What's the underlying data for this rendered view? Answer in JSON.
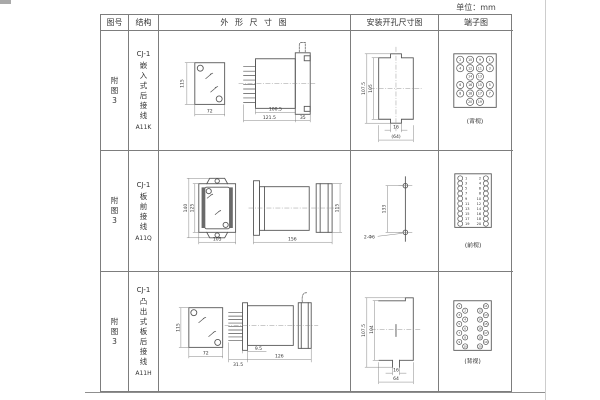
{
  "page": {
    "unit_label": "单位：mm"
  },
  "table": {
    "headers": {
      "fig": "图号",
      "structure": "结构",
      "outline": "外 形 尺 寸 图",
      "mounting": "安装开孔尺寸图",
      "terminal": "端子图"
    }
  },
  "rows": [
    {
      "fig": "附\n图\n3",
      "model": "CJ-1",
      "desc": "嵌\n入\n式\n后\n接\n线",
      "code": "A11K",
      "view_label": "(背视)",
      "dims": {
        "front_h": "115",
        "front_w": "72",
        "body": "100.5",
        "total": "121.5",
        "flange": "35"
      },
      "mount_dims": {
        "outer": "107.5",
        "inner": "105",
        "slot": "16",
        "width": "(64)"
      },
      "terminals": [
        {
          "x": 20.5,
          "y": 29,
          "n": "2"
        },
        {
          "x": 30.5,
          "y": 29,
          "n": "10"
        },
        {
          "x": 40.5,
          "y": 29,
          "n": "9"
        },
        {
          "x": 50.5,
          "y": 29,
          "n": "1"
        },
        {
          "x": 20.5,
          "y": 37.5,
          "n": "4"
        },
        {
          "x": 30.5,
          "y": 37.5,
          "n": "12"
        },
        {
          "x": 40.5,
          "y": 37.5,
          "n": "11"
        },
        {
          "x": 50.5,
          "y": 37.5,
          "n": "3"
        },
        {
          "x": 30.5,
          "y": 46,
          "n": "14"
        },
        {
          "x": 40.5,
          "y": 46,
          "n": "13"
        },
        {
          "x": 20.5,
          "y": 54.5,
          "n": "6"
        },
        {
          "x": 30.5,
          "y": 54.5,
          "n": "16"
        },
        {
          "x": 40.5,
          "y": 54.5,
          "n": "15"
        },
        {
          "x": 50.5,
          "y": 54.5,
          "n": "5"
        },
        {
          "x": 20.5,
          "y": 63,
          "n": "8"
        },
        {
          "x": 30.5,
          "y": 63,
          "n": "18"
        },
        {
          "x": 40.5,
          "y": 63,
          "n": "17"
        },
        {
          "x": 50.5,
          "y": 63,
          "n": "7"
        },
        {
          "x": 30.5,
          "y": 71.5,
          "n": "20"
        },
        {
          "x": 40.5,
          "y": 71.5,
          "n": "19"
        }
      ]
    },
    {
      "fig": "附\n图\n3",
      "model": "CJ-1",
      "desc": "板\n前\n接\n线",
      "code": "A11Q",
      "view_label": "(前视)",
      "dims": {
        "outer_h": "140",
        "inner_h": "125",
        "front_w": "105",
        "depth": "156",
        "side_h": "115"
      },
      "mount_dims": {
        "pitch": "133",
        "holes": "2-Φ6"
      },
      "terminals": [
        {
          "x": 20.5,
          "y": 27.5,
          "n": "1",
          "tx": 25.3,
          "ta": "start"
        },
        {
          "x": 46.5,
          "y": 27.5,
          "n": "2",
          "tx": 41.7,
          "ta": "end"
        },
        {
          "x": 20.5,
          "y": 32.6,
          "n": "3",
          "tx": 25.3,
          "ta": "start"
        },
        {
          "x": 46.5,
          "y": 32.6,
          "n": "4",
          "tx": 41.7,
          "ta": "end"
        },
        {
          "x": 20.5,
          "y": 37.7,
          "n": "5",
          "tx": 25.3,
          "ta": "start"
        },
        {
          "x": 46.5,
          "y": 37.7,
          "n": "6",
          "tx": 41.7,
          "ta": "end"
        },
        {
          "x": 20.5,
          "y": 42.8,
          "n": "7",
          "tx": 25.3,
          "ta": "start"
        },
        {
          "x": 46.5,
          "y": 42.8,
          "n": "8",
          "tx": 41.7,
          "ta": "end"
        },
        {
          "x": 20.5,
          "y": 47.9,
          "n": "9",
          "tx": 25.3,
          "ta": "start"
        },
        {
          "x": 46.5,
          "y": 47.9,
          "n": "10",
          "tx": 41.7,
          "ta": "end"
        },
        {
          "x": 20.5,
          "y": 53,
          "n": "11",
          "tx": 25.3,
          "ta": "start"
        },
        {
          "x": 46.5,
          "y": 53,
          "n": "12",
          "tx": 41.7,
          "ta": "end"
        },
        {
          "x": 20.5,
          "y": 58.1,
          "n": "13",
          "tx": 25.3,
          "ta": "start"
        },
        {
          "x": 46.5,
          "y": 58.1,
          "n": "14",
          "tx": 41.7,
          "ta": "end"
        },
        {
          "x": 20.5,
          "y": 63.2,
          "n": "15",
          "tx": 25.3,
          "ta": "start"
        },
        {
          "x": 46.5,
          "y": 63.2,
          "n": "16",
          "tx": 41.7,
          "ta": "end"
        },
        {
          "x": 20.5,
          "y": 68.3,
          "n": "17",
          "tx": 25.3,
          "ta": "start"
        },
        {
          "x": 46.5,
          "y": 68.3,
          "n": "18",
          "tx": 41.7,
          "ta": "end"
        },
        {
          "x": 20.5,
          "y": 73.4,
          "n": "19",
          "tx": 25.3,
          "ta": "start"
        },
        {
          "x": 46.5,
          "y": 73.4,
          "n": "20",
          "tx": 41.7,
          "ta": "end"
        }
      ]
    },
    {
      "fig": "附\n图\n3",
      "model": "CJ-1",
      "desc": "凸\n出\n式\n板\n后\n接\n线",
      "code": "A11H",
      "view_label": "(背视)",
      "dims": {
        "front_h": "115",
        "front_w": "72",
        "plate": "31.5",
        "pin": "9.5",
        "depth": "126"
      },
      "mount_dims": {
        "outer": "107.5",
        "inner": "104",
        "slot": "16",
        "width": "64"
      },
      "terminals": [
        {
          "x": 19.5,
          "y": 33.5,
          "n": "1"
        },
        {
          "x": 25.5,
          "y": 38,
          "n": "2"
        },
        {
          "x": 19.5,
          "y": 42.5,
          "n": "3"
        },
        {
          "x": 25.5,
          "y": 47,
          "n": "4"
        },
        {
          "x": 19.5,
          "y": 51.5,
          "n": "5"
        },
        {
          "x": 25.5,
          "y": 56,
          "n": "6"
        },
        {
          "x": 19.5,
          "y": 60.5,
          "n": "7"
        },
        {
          "x": 25.5,
          "y": 65,
          "n": "8"
        },
        {
          "x": 19.5,
          "y": 69.5,
          "n": "9"
        },
        {
          "x": 25.5,
          "y": 74,
          "n": "10"
        },
        {
          "x": 46.5,
          "y": 33.5,
          "n": "11"
        },
        {
          "x": 40.5,
          "y": 38,
          "n": "12"
        },
        {
          "x": 46.5,
          "y": 42.5,
          "n": "13"
        },
        {
          "x": 40.5,
          "y": 47,
          "n": "14"
        },
        {
          "x": 46.5,
          "y": 51.5,
          "n": "15"
        },
        {
          "x": 40.5,
          "y": 56,
          "n": "16"
        },
        {
          "x": 46.5,
          "y": 60.5,
          "n": "17"
        },
        {
          "x": 40.5,
          "y": 65,
          "n": "18"
        },
        {
          "x": 46.5,
          "y": 69.5,
          "n": "19"
        },
        {
          "x": 40.5,
          "y": 74,
          "n": "20"
        }
      ]
    }
  ]
}
